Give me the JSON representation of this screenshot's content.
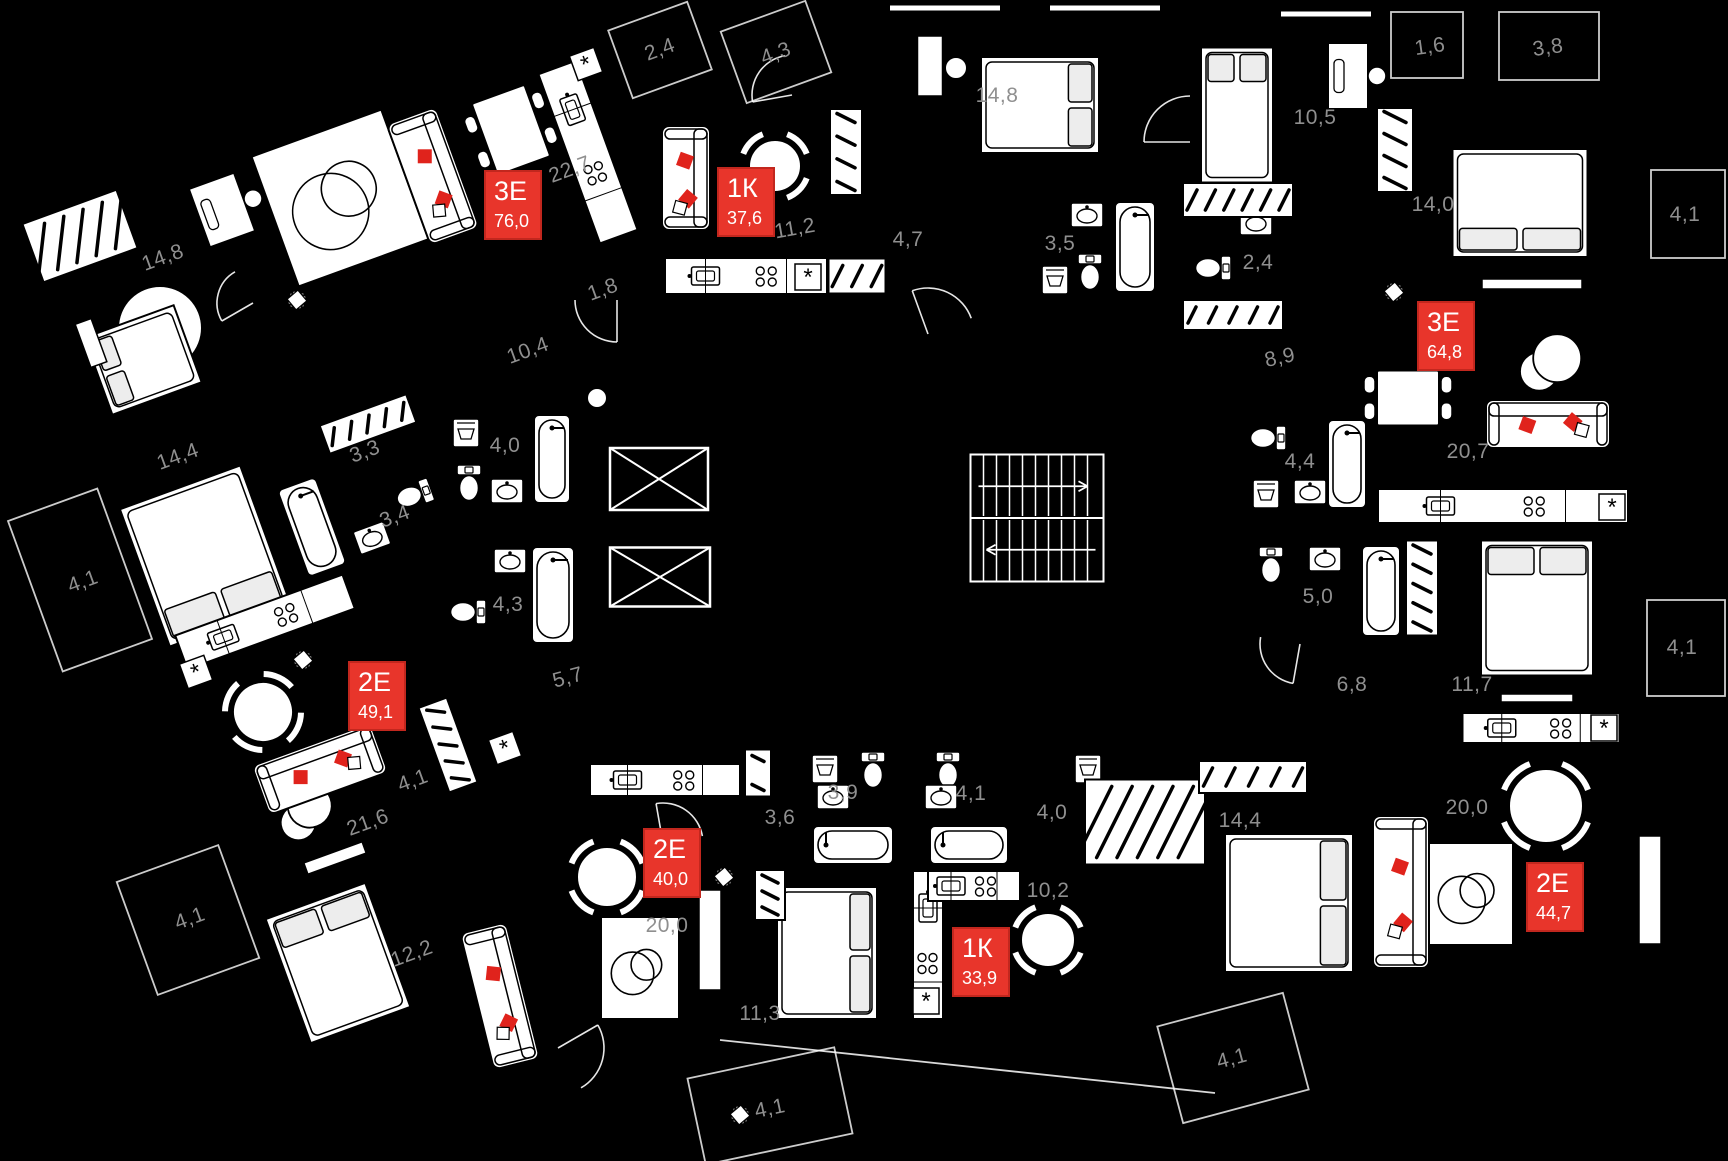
{
  "canvas": {
    "width": 1728,
    "height": 1161,
    "background": "#000000"
  },
  "palette": {
    "badge_red": "#e8352b",
    "badge_border": "#c2271e",
    "badge_text": "#ffffff",
    "label_gray": "#8f8f8f",
    "line": "#ffffff",
    "accent_pillow": "#e0231c"
  },
  "apartments": [
    {
      "type": "3Е",
      "area": "76,0",
      "x": 513,
      "y": 205
    },
    {
      "type": "1К",
      "area": "37,6",
      "x": 746,
      "y": 202
    },
    {
      "type": "3Е",
      "area": "64,8",
      "x": 1446,
      "y": 336
    },
    {
      "type": "2Е",
      "area": "49,1",
      "x": 377,
      "y": 696
    },
    {
      "type": "2Е",
      "area": "40,0",
      "x": 672,
      "y": 863
    },
    {
      "type": "1К",
      "area": "33,9",
      "x": 981,
      "y": 962
    },
    {
      "type": "2Е",
      "area": "44,7",
      "x": 1555,
      "y": 897
    }
  ],
  "room_labels": [
    {
      "text": "14,8",
      "x": 163,
      "y": 258,
      "r": -20
    },
    {
      "text": "22,7",
      "x": 570,
      "y": 170,
      "r": -20
    },
    {
      "text": "10,4",
      "x": 528,
      "y": 351,
      "r": -20
    },
    {
      "text": "1,8",
      "x": 603,
      "y": 290,
      "r": -20
    },
    {
      "text": "2,4",
      "x": 660,
      "y": 50,
      "r": -20
    },
    {
      "text": "4,3",
      "x": 776,
      "y": 54,
      "r": -20
    },
    {
      "text": "11,2",
      "x": 795,
      "y": 229,
      "r": -10
    },
    {
      "text": "14,8",
      "x": 997,
      "y": 96,
      "r": 0
    },
    {
      "text": "4,7",
      "x": 908,
      "y": 240,
      "r": 0
    },
    {
      "text": "3,5",
      "x": 1060,
      "y": 244,
      "r": 0
    },
    {
      "text": "10,5",
      "x": 1315,
      "y": 118,
      "r": 0
    },
    {
      "text": "1,6",
      "x": 1430,
      "y": 47,
      "r": -8
    },
    {
      "text": "3,8",
      "x": 1548,
      "y": 48,
      "r": -8
    },
    {
      "text": "14,0",
      "x": 1433,
      "y": 205,
      "r": 0
    },
    {
      "text": "4,1",
      "x": 1685,
      "y": 215,
      "r": 0
    },
    {
      "text": "2,4",
      "x": 1258,
      "y": 263,
      "r": 0
    },
    {
      "text": "8,9",
      "x": 1280,
      "y": 358,
      "r": -12
    },
    {
      "text": "14,4",
      "x": 178,
      "y": 457,
      "r": -20
    },
    {
      "text": "3,3",
      "x": 365,
      "y": 452,
      "r": -20
    },
    {
      "text": "4,0",
      "x": 505,
      "y": 446,
      "r": 0
    },
    {
      "text": "4,1",
      "x": 83,
      "y": 582,
      "r": -20
    },
    {
      "text": "3,4",
      "x": 395,
      "y": 517,
      "r": -20
    },
    {
      "text": "4,3",
      "x": 508,
      "y": 605,
      "r": 0
    },
    {
      "text": "5,7",
      "x": 568,
      "y": 678,
      "r": -15
    },
    {
      "text": "4,4",
      "x": 1300,
      "y": 462,
      "r": 0
    },
    {
      "text": "20,7",
      "x": 1468,
      "y": 452,
      "r": 0
    },
    {
      "text": "5,0",
      "x": 1318,
      "y": 597,
      "r": 0
    },
    {
      "text": "4,1",
      "x": 1682,
      "y": 648,
      "r": 0
    },
    {
      "text": "6,8",
      "x": 1352,
      "y": 685,
      "r": 0
    },
    {
      "text": "11,7",
      "x": 1472,
      "y": 685,
      "r": 0
    },
    {
      "text": "4,1",
      "x": 413,
      "y": 781,
      "r": -20
    },
    {
      "text": "21,6",
      "x": 368,
      "y": 823,
      "r": -20
    },
    {
      "text": "4,1",
      "x": 190,
      "y": 919,
      "r": -20
    },
    {
      "text": "12,2",
      "x": 412,
      "y": 954,
      "r": -20
    },
    {
      "text": "3,9",
      "x": 843,
      "y": 793,
      "r": 0
    },
    {
      "text": "4,1",
      "x": 971,
      "y": 794,
      "r": 0
    },
    {
      "text": "3,6",
      "x": 780,
      "y": 818,
      "r": 0
    },
    {
      "text": "4,0",
      "x": 1052,
      "y": 813,
      "r": 0
    },
    {
      "text": "20,0",
      "x": 667,
      "y": 926,
      "r": 0
    },
    {
      "text": "10,2",
      "x": 1048,
      "y": 891,
      "r": 0
    },
    {
      "text": "11,3",
      "x": 760,
      "y": 1014,
      "r": 0
    },
    {
      "text": "4,1",
      "x": 770,
      "y": 1109,
      "r": -12
    },
    {
      "text": "14,4",
      "x": 1240,
      "y": 821,
      "r": 0
    },
    {
      "text": "20,0",
      "x": 1467,
      "y": 808,
      "r": 0
    },
    {
      "text": "4,1",
      "x": 1232,
      "y": 1059,
      "r": -15
    }
  ],
  "furniture": [
    {
      "k": "circle",
      "x": 160,
      "y": 328,
      "rad": 42
    },
    {
      "k": "circle",
      "x": 956,
      "y": 68,
      "rad": 11
    },
    {
      "k": "circle",
      "x": 597,
      "y": 398,
      "rad": 10
    },
    {
      "k": "bed",
      "x": 143,
      "y": 360,
      "w": 95,
      "h": 82,
      "r": -20,
      "v": "W"
    },
    {
      "k": "bed",
      "x": 1040,
      "y": 105,
      "w": 118,
      "h": 96,
      "r": 0,
      "v": "E"
    },
    {
      "k": "bed",
      "x": 1237,
      "y": 115,
      "w": 72,
      "h": 135,
      "r": 0,
      "v": "N"
    },
    {
      "k": "bed",
      "x": 1520,
      "y": 203,
      "w": 135,
      "h": 108,
      "r": 0,
      "v": "S"
    },
    {
      "k": "bed",
      "x": 1537,
      "y": 608,
      "w": 112,
      "h": 135,
      "r": 0,
      "v": "N"
    },
    {
      "k": "bed",
      "x": 1289,
      "y": 903,
      "w": 128,
      "h": 138,
      "r": 0,
      "v": "E"
    },
    {
      "k": "bed",
      "x": 827,
      "y": 953,
      "w": 100,
      "h": 132,
      "r": 0,
      "v": "E"
    },
    {
      "k": "bed",
      "x": 205,
      "y": 556,
      "w": 128,
      "h": 146,
      "r": -20,
      "v": "S"
    },
    {
      "k": "bed",
      "x": 338,
      "y": 963,
      "w": 106,
      "h": 132,
      "r": -20,
      "v": "N"
    },
    {
      "k": "rug",
      "x": 340,
      "y": 198,
      "w": 136,
      "h": 136,
      "r": -20
    },
    {
      "k": "rug",
      "x": 640,
      "y": 968,
      "w": 76,
      "h": 100,
      "r": 0
    },
    {
      "k": "rug",
      "x": 1470,
      "y": 894,
      "w": 84,
      "h": 100,
      "r": 0
    },
    {
      "k": "circles",
      "x": 305,
      "y": 812,
      "rad": 22,
      "r": -20
    },
    {
      "k": "circles",
      "x": 1550,
      "y": 363,
      "rad": 24,
      "r": 0
    },
    {
      "k": "sofa",
      "x": 433,
      "y": 176,
      "w": 52,
      "h": 128,
      "r": -20
    },
    {
      "k": "sofa",
      "x": 686,
      "y": 178,
      "w": 48,
      "h": 104,
      "r": 0
    },
    {
      "k": "sofa",
      "x": 1548,
      "y": 424,
      "w": 124,
      "h": 48,
      "r": 0
    },
    {
      "k": "sofa",
      "x": 320,
      "y": 769,
      "w": 126,
      "h": 52,
      "r": -20
    },
    {
      "k": "sofa",
      "x": 1401,
      "y": 892,
      "w": 56,
      "h": 152,
      "r": 0
    },
    {
      "k": "sofa",
      "x": 500,
      "y": 996,
      "w": 47,
      "h": 140,
      "r": -14
    },
    {
      "k": "table",
      "x": 511,
      "y": 130,
      "w": 56,
      "h": 76,
      "r": -20
    },
    {
      "k": "table",
      "x": 1408,
      "y": 398,
      "w": 62,
      "h": 55,
      "r": 0
    },
    {
      "k": "rtable",
      "x": 775,
      "y": 166,
      "rad": 26,
      "r": 0
    },
    {
      "k": "rtable",
      "x": 263,
      "y": 712,
      "rad": 30,
      "r": -20
    },
    {
      "k": "rtable",
      "x": 607,
      "y": 877,
      "rad": 30,
      "r": 0
    },
    {
      "k": "rtable",
      "x": 1048,
      "y": 940,
      "rad": 27,
      "r": 0
    },
    {
      "k": "rtable",
      "x": 1546,
      "y": 806,
      "rad": 37,
      "r": 0
    },
    {
      "k": "kitchen",
      "x": 588,
      "y": 152,
      "w": 40,
      "h": 180,
      "r": -20
    },
    {
      "k": "kitchen",
      "x": 746,
      "y": 276,
      "w": 162,
      "h": 36,
      "r": 0
    },
    {
      "k": "kitchen",
      "x": 1503,
      "y": 506,
      "w": 250,
      "h": 34,
      "r": 0
    },
    {
      "k": "kitchen",
      "x": 1541,
      "y": 728,
      "w": 157,
      "h": 30,
      "r": 0
    },
    {
      "k": "kitchen",
      "x": 665,
      "y": 780,
      "w": 150,
      "h": 32,
      "r": 0
    },
    {
      "k": "kitchen",
      "x": 928,
      "y": 945,
      "w": 30,
      "h": 148,
      "r": 0
    },
    {
      "k": "kitchen",
      "x": 974,
      "y": 886,
      "w": 92,
      "h": 30,
      "r": 0
    },
    {
      "k": "kitchen",
      "x": 265,
      "y": 622,
      "w": 178,
      "h": 36,
      "r": -20
    },
    {
      "k": "bathtub",
      "x": 1135,
      "y": 247,
      "w": 40,
      "h": 90,
      "r": 0
    },
    {
      "k": "bathtub",
      "x": 1347,
      "y": 464,
      "w": 38,
      "h": 88,
      "r": 0
    },
    {
      "k": "bathtub",
      "x": 1381,
      "y": 591,
      "w": 38,
      "h": 90,
      "r": 0
    },
    {
      "k": "bathtub",
      "x": 553,
      "y": 595,
      "w": 42,
      "h": 96,
      "r": 0
    },
    {
      "k": "bathtub",
      "x": 552,
      "y": 459,
      "w": 36,
      "h": 88,
      "r": 0
    },
    {
      "k": "bathtub",
      "x": 312,
      "y": 527,
      "w": 40,
      "h": 92,
      "r": -20
    },
    {
      "k": "bathtub",
      "x": 853,
      "y": 845,
      "w": 80,
      "h": 38,
      "r": 0
    },
    {
      "k": "bathtub",
      "x": 969,
      "y": 845,
      "w": 78,
      "h": 38,
      "r": 0
    },
    {
      "k": "toilet",
      "x": 1090,
      "y": 272,
      "r": 0
    },
    {
      "k": "toilet",
      "x": 1213,
      "y": 268,
      "r": 90
    },
    {
      "k": "toilet",
      "x": 1268,
      "y": 438,
      "r": 90
    },
    {
      "k": "toilet",
      "x": 1271,
      "y": 565,
      "r": 0
    },
    {
      "k": "toilet",
      "x": 468,
      "y": 612,
      "r": 90
    },
    {
      "k": "toilet",
      "x": 469,
      "y": 483,
      "r": 0
    },
    {
      "k": "toilet",
      "x": 414,
      "y": 495,
      "r": 70
    },
    {
      "k": "toilet",
      "x": 873,
      "y": 770,
      "r": 0
    },
    {
      "k": "toilet",
      "x": 948,
      "y": 770,
      "r": 0
    },
    {
      "k": "sink",
      "x": 1087,
      "y": 215,
      "r": 0
    },
    {
      "k": "sink",
      "x": 1256,
      "y": 223,
      "r": 0
    },
    {
      "k": "sink",
      "x": 1310,
      "y": 492,
      "r": 0
    },
    {
      "k": "sink",
      "x": 1325,
      "y": 559,
      "r": 0
    },
    {
      "k": "sink",
      "x": 510,
      "y": 561,
      "r": 0
    },
    {
      "k": "sink",
      "x": 507,
      "y": 491,
      "r": 0
    },
    {
      "k": "sink",
      "x": 372,
      "y": 538,
      "r": -20
    },
    {
      "k": "sink",
      "x": 833,
      "y": 797,
      "r": 0
    },
    {
      "k": "sink",
      "x": 941,
      "y": 797,
      "r": 0
    },
    {
      "k": "washer",
      "x": 1055,
      "y": 280,
      "r": 0
    },
    {
      "k": "washer",
      "x": 1266,
      "y": 494,
      "r": 0
    },
    {
      "k": "washer",
      "x": 466,
      "y": 433,
      "r": 0
    },
    {
      "k": "washer",
      "x": 825,
      "y": 769,
      "r": 0
    },
    {
      "k": "washer",
      "x": 1088,
      "y": 769,
      "r": 0
    },
    {
      "k": "wardrobe",
      "x": 80,
      "y": 236,
      "w": 100,
      "h": 62,
      "r": -20
    },
    {
      "k": "wardrobe",
      "x": 846,
      "y": 152,
      "w": 32,
      "h": 86,
      "r": 0
    },
    {
      "k": "wardrobe",
      "x": 857,
      "y": 276,
      "w": 57,
      "h": 35,
      "r": 0
    },
    {
      "k": "wardrobe",
      "x": 1238,
      "y": 200,
      "w": 110,
      "h": 34,
      "r": 0
    },
    {
      "k": "wardrobe",
      "x": 1233,
      "y": 315,
      "w": 100,
      "h": 30,
      "r": 0
    },
    {
      "k": "wardrobe",
      "x": 1395,
      "y": 150,
      "w": 36,
      "h": 84,
      "r": 0
    },
    {
      "k": "wardrobe",
      "x": 1422,
      "y": 588,
      "w": 32,
      "h": 95,
      "r": 0
    },
    {
      "k": "wardrobe",
      "x": 758,
      "y": 773,
      "w": 26,
      "h": 47,
      "r": 0
    },
    {
      "k": "wardrobe",
      "x": 770,
      "y": 895,
      "w": 30,
      "h": 50,
      "r": 0
    },
    {
      "k": "wardrobe",
      "x": 1145,
      "y": 822,
      "w": 120,
      "h": 85,
      "r": 0
    },
    {
      "k": "wardrobe",
      "x": 448,
      "y": 745,
      "w": 30,
      "h": 90,
      "r": -20
    },
    {
      "k": "wardrobe",
      "x": 368,
      "y": 424,
      "w": 92,
      "h": 30,
      "r": -20
    },
    {
      "k": "wardrobe",
      "x": 1253,
      "y": 777,
      "w": 108,
      "h": 32,
      "r": 0
    },
    {
      "k": "desk",
      "x": 222,
      "y": 210,
      "w": 48,
      "h": 62,
      "r": -20
    },
    {
      "k": "desk",
      "x": 1348,
      "y": 76,
      "w": 40,
      "h": 66,
      "r": 0
    },
    {
      "k": "tv",
      "x": 1532,
      "y": 284,
      "w": 100,
      "h": 10,
      "r": 0
    },
    {
      "k": "tv",
      "x": 1537,
      "y": 698,
      "w": 72,
      "h": 8,
      "r": 0
    },
    {
      "k": "tv",
      "x": 1650,
      "y": 890,
      "w": 22,
      "h": 108,
      "r": 0
    },
    {
      "k": "tv",
      "x": 710,
      "y": 940,
      "w": 22,
      "h": 100,
      "r": 0
    },
    {
      "k": "tv",
      "x": 335,
      "y": 858,
      "w": 62,
      "h": 12,
      "r": -20
    },
    {
      "k": "tv",
      "x": 91,
      "y": 343,
      "w": 17,
      "h": 46,
      "r": -20
    },
    {
      "k": "elevator",
      "x": 659,
      "y": 479,
      "w": 98,
      "h": 62,
      "r": 0
    },
    {
      "k": "elevator",
      "x": 660,
      "y": 577,
      "w": 100,
      "h": 59,
      "r": 0
    },
    {
      "k": "stairs",
      "x": 1037,
      "y": 518,
      "w": 133,
      "h": 127,
      "r": 0
    },
    {
      "k": "pillar",
      "x": 930,
      "y": 66,
      "w": 25,
      "h": 60,
      "r": 0
    },
    {
      "k": "star",
      "x": 586,
      "y": 64,
      "r": -20
    },
    {
      "k": "star",
      "x": 808,
      "y": 277,
      "r": 0
    },
    {
      "k": "star",
      "x": 1612,
      "y": 507,
      "r": 0
    },
    {
      "k": "star",
      "x": 1604,
      "y": 728,
      "r": 0
    },
    {
      "k": "star",
      "x": 926,
      "y": 1001,
      "r": 0
    },
    {
      "k": "star",
      "x": 196,
      "y": 672,
      "r": -20
    },
    {
      "k": "star",
      "x": 505,
      "y": 748,
      "r": -20
    },
    {
      "k": "plant",
      "x": 297,
      "y": 300,
      "r": 0
    },
    {
      "k": "plant",
      "x": 1394,
      "y": 292,
      "r": 0
    },
    {
      "k": "plant",
      "x": 724,
      "y": 877,
      "r": 0
    },
    {
      "k": "plant",
      "x": 740,
      "y": 1115,
      "r": 0
    },
    {
      "k": "plant",
      "x": 303,
      "y": 660,
      "r": 0
    },
    {
      "k": "balcony",
      "x": 660,
      "y": 50,
      "w": 84,
      "h": 72,
      "r": -20
    },
    {
      "k": "balcony",
      "x": 776,
      "y": 52,
      "w": 90,
      "h": 76,
      "r": -20
    },
    {
      "k": "balcony",
      "x": 1427,
      "y": 45,
      "w": 72,
      "h": 66,
      "r": 0
    },
    {
      "k": "balcony",
      "x": 1549,
      "y": 46,
      "w": 100,
      "h": 68,
      "r": 0
    },
    {
      "k": "balcony",
      "x": 1688,
      "y": 214,
      "w": 74,
      "h": 88,
      "r": 0
    },
    {
      "k": "balcony",
      "x": 1686,
      "y": 648,
      "w": 78,
      "h": 96,
      "r": 0
    },
    {
      "k": "balcony",
      "x": 80,
      "y": 580,
      "w": 95,
      "h": 160,
      "r": -20
    },
    {
      "k": "balcony",
      "x": 188,
      "y": 920,
      "w": 108,
      "h": 120,
      "r": -20
    },
    {
      "k": "balcony",
      "x": 770,
      "y": 1106,
      "w": 150,
      "h": 88,
      "r": -12
    },
    {
      "k": "balcony",
      "x": 1233,
      "y": 1058,
      "w": 130,
      "h": 100,
      "r": -15
    },
    {
      "k": "strip",
      "x": 945,
      "y": 8,
      "w": 110,
      "h": 5,
      "r": 0
    },
    {
      "k": "strip",
      "x": 1105,
      "y": 8,
      "w": 110,
      "h": 5,
      "r": 0
    },
    {
      "k": "strip",
      "x": 1326,
      "y": 14,
      "w": 90,
      "h": 5,
      "r": 0
    },
    {
      "k": "arc",
      "x": 253,
      "y": 303,
      "rad": 36,
      "r": 150
    },
    {
      "k": "arc",
      "x": 617,
      "y": 300,
      "rad": 42,
      "r": 90
    },
    {
      "k": "arc",
      "x": 792,
      "y": 95,
      "rad": 40,
      "r": 170
    },
    {
      "k": "arc",
      "x": 928,
      "y": 334,
      "rad": 46,
      "r": 250
    },
    {
      "k": "arc",
      "x": 1190,
      "y": 142,
      "rad": 46,
      "r": 180
    },
    {
      "k": "arc",
      "x": 1300,
      "y": 644,
      "rad": 40,
      "r": 100
    },
    {
      "k": "arc",
      "x": 663,
      "y": 843,
      "rad": 40,
      "r": 260
    },
    {
      "k": "arc",
      "x": 558,
      "y": 1048,
      "rad": 46,
      "r": 330
    },
    {
      "k": "line",
      "x1": 720,
      "y1": 1040,
      "x2": 1215,
      "y2": 1093
    }
  ]
}
